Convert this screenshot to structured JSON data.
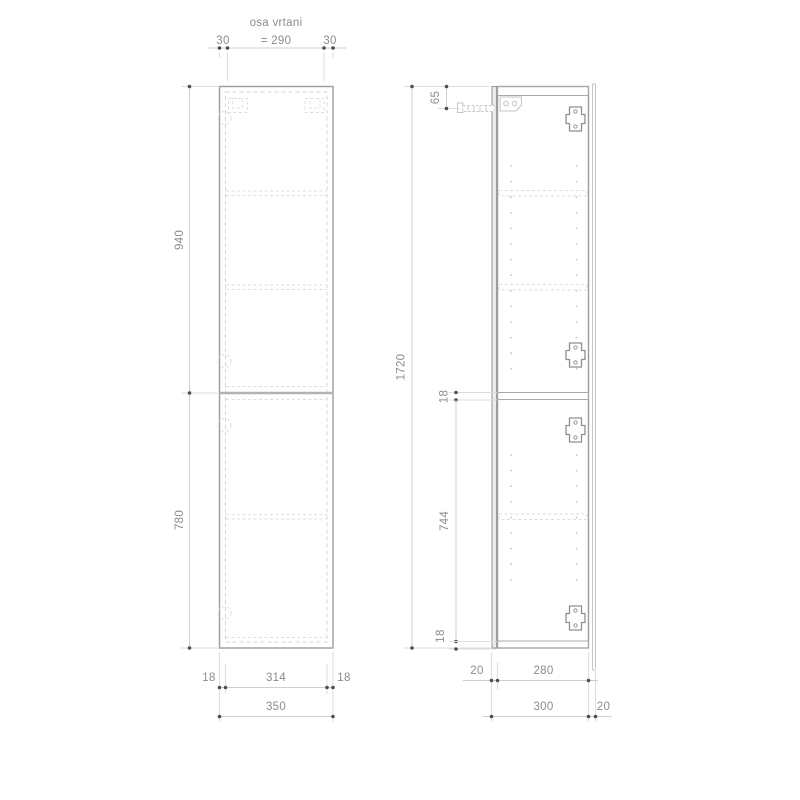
{
  "annotation": {
    "title": "osa vrtani"
  },
  "front": {
    "dim_top_left": "30",
    "dim_top_axis": "= 290",
    "dim_top_right": "30",
    "dim_upper_height": "940",
    "dim_lower_height": "780",
    "dim_bottom_left_thickness": "18",
    "dim_bottom_inner_width": "314",
    "dim_bottom_right_thickness": "18",
    "dim_bottom_total_width": "350"
  },
  "side": {
    "dim_hanger_offset": "65",
    "dim_total_height": "1720",
    "dim_divider_thickness": "18",
    "dim_lower_section": "744",
    "dim_bottom_thickness": "18",
    "dim_door_depth": "20",
    "dim_body_depth": "280",
    "dim_total_depth": "300",
    "dim_back_clearance": "20"
  },
  "colors": {
    "outline": "#9c9c9c",
    "dashed_line": "#d6d6d6",
    "dimension_line": "#cfcfcf",
    "text": "#8c8c8c",
    "marker_dot": "#4f4f4f",
    "background": "#ffffff"
  }
}
